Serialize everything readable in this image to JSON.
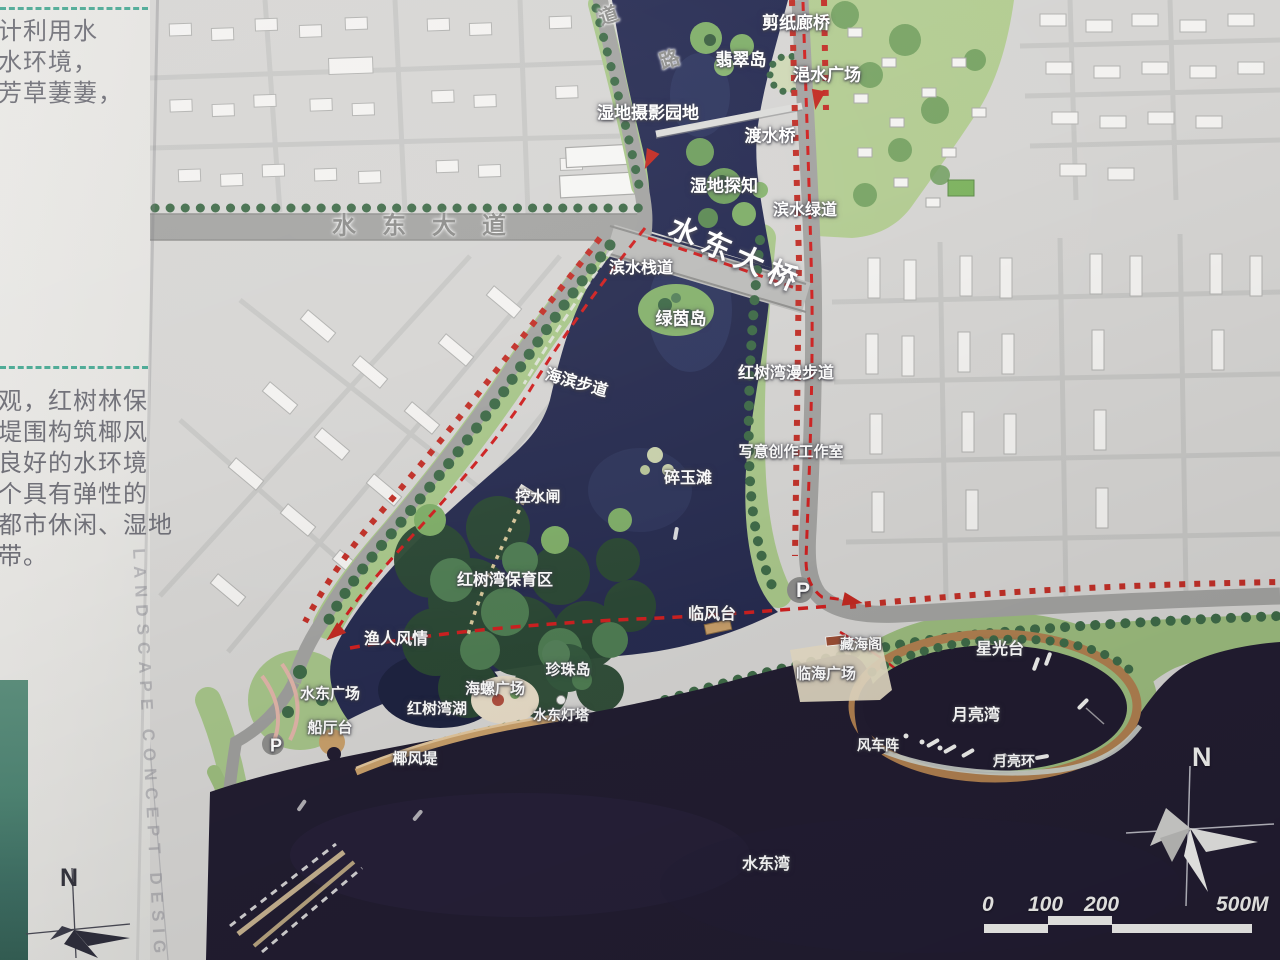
{
  "left_panel": {
    "intro_lines": [
      "计利用水",
      "水环境，",
      "芳草萋萋，"
    ],
    "body_lines": [
      "观，红树林保",
      "堤围构筑椰风",
      "良好的水环境",
      "个具有弹性的",
      "都市休闲、湿地",
      "带。"
    ],
    "vertical_caption": "LANDSCAPE CONCEPT DESIGN",
    "compass_label": "N"
  },
  "compass_right": {
    "label": "N"
  },
  "scale_bar": {
    "ticks": [
      "0",
      "100",
      "200",
      "500M"
    ]
  },
  "colors": {
    "river_water": "#262b52",
    "bay_water": "#221d31",
    "park_green": "#a9c78a",
    "mangrove_green": "#2c4a34",
    "route_red": "#d02020",
    "sand_tan": "#b98e5f",
    "divider_teal": "#2e9e86"
  },
  "map": {
    "labels": [
      {
        "id": "road-char-dao",
        "t": "道",
        "x": 608,
        "y": 14,
        "fs": 20,
        "rot": -18,
        "cls": "roadchar"
      },
      {
        "id": "road-char-lu",
        "t": "路",
        "x": 669,
        "y": 58,
        "fs": 20,
        "rot": -18,
        "cls": "roadchar"
      },
      {
        "id": "paper-cut-gallery-bridge",
        "t": "剪纸廊桥",
        "x": 796,
        "y": 21,
        "fs": 17
      },
      {
        "id": "jade-island",
        "t": "翡翠岛",
        "x": 741,
        "y": 58,
        "fs": 17
      },
      {
        "id": "yishui-plaza",
        "t": "浥水广场",
        "x": 827,
        "y": 73,
        "fs": 17
      },
      {
        "id": "wetland-photography-garden",
        "t": "湿地摄影园地",
        "x": 648,
        "y": 111,
        "fs": 17
      },
      {
        "id": "water-crossing-bridge",
        "t": "渡水桥",
        "x": 770,
        "y": 134,
        "fs": 17
      },
      {
        "id": "wetland-discovery",
        "t": "湿地探知",
        "x": 724,
        "y": 184,
        "fs": 17
      },
      {
        "id": "waterfront-greenway",
        "t": "滨水绿道",
        "x": 805,
        "y": 208,
        "fs": 16
      },
      {
        "id": "shuidong-avenue",
        "t": "水东大道",
        "x": 432,
        "y": 223,
        "fs": 24,
        "cls": "avenue"
      },
      {
        "id": "shuidong-bridge",
        "t": "水东大桥",
        "x": 737,
        "y": 253,
        "fs": 29,
        "rot": 24,
        "cls": "bigname"
      },
      {
        "id": "waterfront-boardwalk",
        "t": "滨水栈道",
        "x": 641,
        "y": 266,
        "fs": 16
      },
      {
        "id": "green-meadow-island",
        "t": "绿茵岛",
        "x": 681,
        "y": 317,
        "fs": 17
      },
      {
        "id": "seaside-footpath",
        "t": "海滨步道",
        "x": 577,
        "y": 381,
        "fs": 16,
        "rot": 16
      },
      {
        "id": "mangrove-bay-promenade",
        "t": "红树湾漫步道",
        "x": 786,
        "y": 371,
        "fs": 16
      },
      {
        "id": "freehand-creation-studio",
        "t": "写意创作工作室",
        "x": 791,
        "y": 451,
        "fs": 15
      },
      {
        "id": "jade-shard-beach",
        "t": "碎玉滩",
        "x": 688,
        "y": 476,
        "fs": 16
      },
      {
        "id": "water-control-gate",
        "t": "控水闸",
        "x": 538,
        "y": 496,
        "fs": 15
      },
      {
        "id": "mangrove-bay-reserve",
        "t": "红树湾保育区",
        "x": 505,
        "y": 578,
        "fs": 16
      },
      {
        "id": "fisherman-life",
        "t": "渔人风情",
        "x": 396,
        "y": 637,
        "fs": 16
      },
      {
        "id": "wind-facing-terrace",
        "t": "临风台",
        "x": 712,
        "y": 612,
        "fs": 16
      },
      {
        "id": "parking-east",
        "t": "P",
        "x": 803,
        "y": 591,
        "fs": 21,
        "cls": "parking"
      },
      {
        "id": "canghai-pavilion",
        "t": "藏海阁",
        "x": 861,
        "y": 644,
        "fs": 14
      },
      {
        "id": "seaside-plaza",
        "t": "临海广场",
        "x": 826,
        "y": 673,
        "fs": 15
      },
      {
        "id": "starlight-terrace",
        "t": "星光台",
        "x": 1000,
        "y": 647,
        "fs": 16
      },
      {
        "id": "shuidong-plaza",
        "t": "水东广场",
        "x": 330,
        "y": 693,
        "fs": 15
      },
      {
        "id": "pearl-island",
        "t": "珍珠岛",
        "x": 568,
        "y": 669,
        "fs": 15
      },
      {
        "id": "conch-plaza",
        "t": "海螺广场",
        "x": 495,
        "y": 688,
        "fs": 15
      },
      {
        "id": "mangrove-bay-lake",
        "t": "红树湾湖",
        "x": 437,
        "y": 708,
        "fs": 15
      },
      {
        "id": "shuidong-lighthouse",
        "t": "水东灯塔",
        "x": 561,
        "y": 715,
        "fs": 14
      },
      {
        "id": "boat-hall-terrace",
        "t": "船厅台",
        "x": 330,
        "y": 727,
        "fs": 15
      },
      {
        "id": "parking-west",
        "t": "P",
        "x": 276,
        "y": 746,
        "fs": 18,
        "cls": "parking"
      },
      {
        "id": "coconut-breeze-dike",
        "t": "椰风堤",
        "x": 415,
        "y": 758,
        "fs": 15
      },
      {
        "id": "moon-bay",
        "t": "月亮湾",
        "x": 976,
        "y": 713,
        "fs": 16
      },
      {
        "id": "windmill-array",
        "t": "风车阵",
        "x": 878,
        "y": 745,
        "fs": 14
      },
      {
        "id": "moon-ring",
        "t": "月亮环",
        "x": 1014,
        "y": 761,
        "fs": 14
      },
      {
        "id": "shuidong-bay",
        "t": "水东湾",
        "x": 766,
        "y": 862,
        "fs": 16
      }
    ]
  }
}
